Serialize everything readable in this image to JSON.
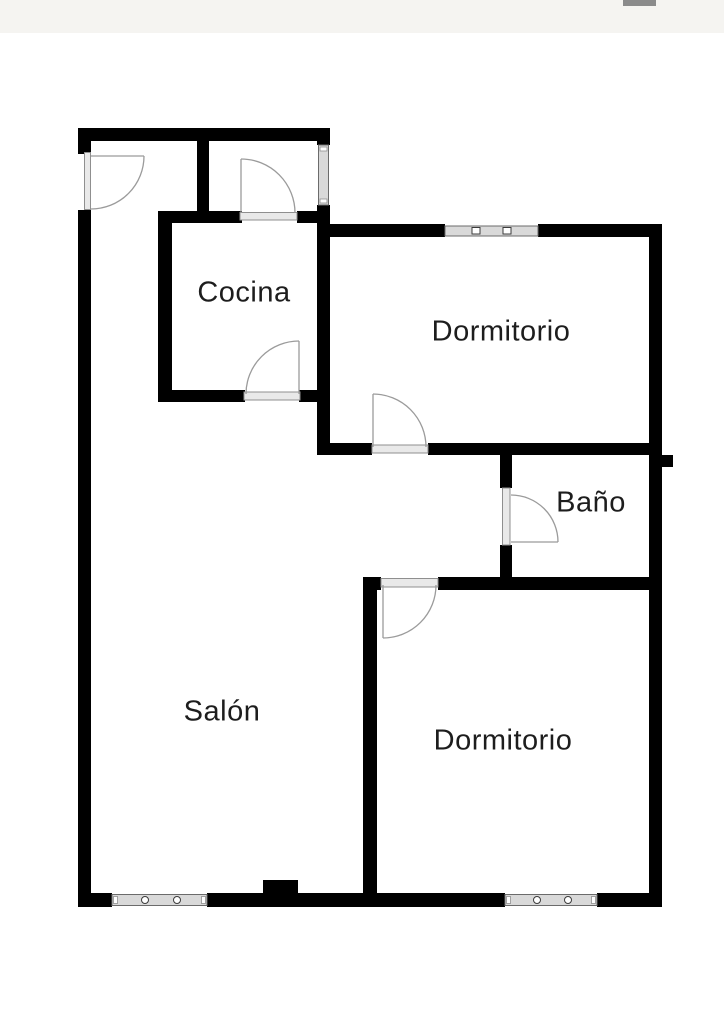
{
  "colors": {
    "wall": "#000000",
    "door": "#9b9b9b",
    "threshold-fill": "#e9e9e9",
    "threshold-stroke": "#8f8f8f",
    "window-fill": "#d9d9d9",
    "window-stroke": "#6b6b6b",
    "label": "#1d1d1d",
    "band": "#f5f4f1",
    "sliver": "#8b8b8b"
  },
  "rooms": [
    {
      "id": "cocina",
      "label": "Cocina"
    },
    {
      "id": "dormitorio-1",
      "label": "Dormitorio"
    },
    {
      "id": "bano",
      "label": "Baño"
    },
    {
      "id": "salon",
      "label": "Salón"
    },
    {
      "id": "dormitorio-2",
      "label": "Dormitorio"
    }
  ]
}
